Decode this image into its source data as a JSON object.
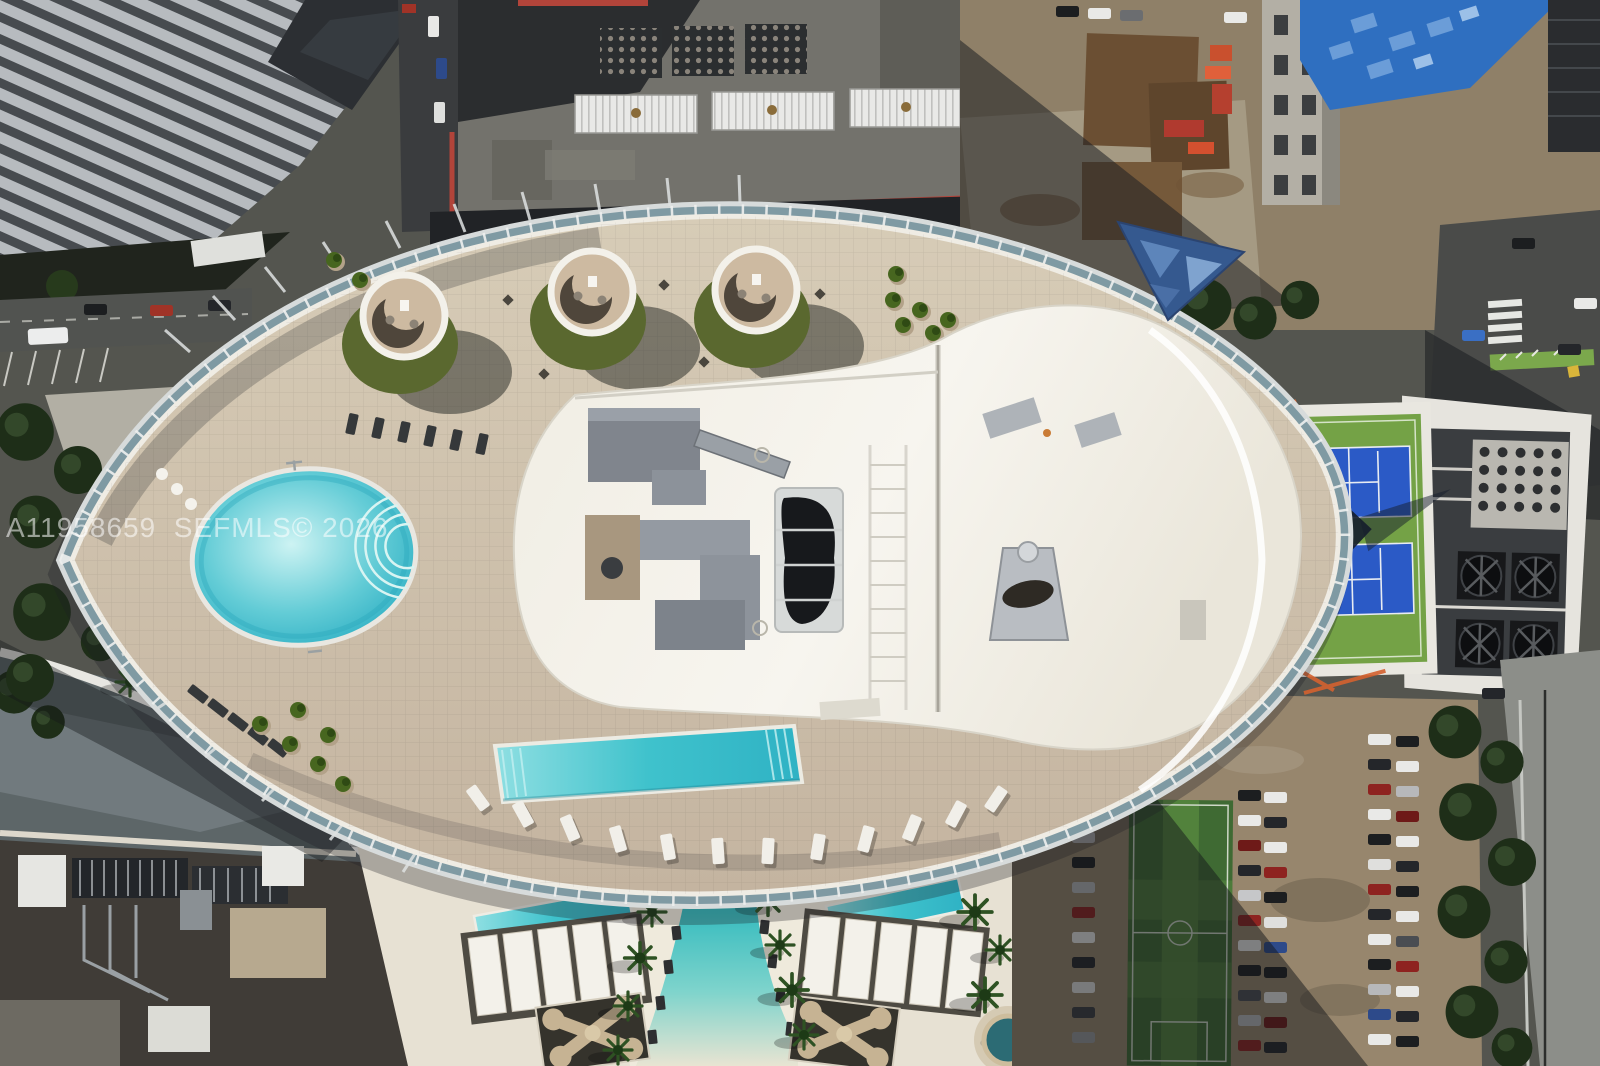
{
  "watermark": {
    "text": "A11958659  SEFMLS© 2026"
  },
  "palette": {
    "asphalt": "#54554f",
    "deck": "#cdc0aa",
    "roof": "#f4f1e9",
    "podGrass": "#5a682f",
    "poolTurquoise": "#35b6c6",
    "rimGlass": "#7f9aa3",
    "courtBlue": "#2b5ac6",
    "courtGreen": "#74a246",
    "fieldGreen": "#3f6a33",
    "dirtTan": "#8f8068",
    "lotTan": "#97866d",
    "hoistBlue": "#2f6fc0",
    "parapetRed": "#b2443a",
    "white": "#eeece6",
    "shadow": "#17191d",
    "watermark": "rgba(255,255,255,0.55)"
  },
  "scene": {
    "type": "aerial-photo",
    "regions": [
      "oval rooftop amenity deck",
      "round pool",
      "lap pool",
      "cabana pods",
      "penthouse roof",
      "glass pyramid skylight",
      "tennis courts",
      "cooling-fan roof",
      "construction site",
      "parking lot",
      "soccer field",
      "ground-level lagoon pool deck",
      "city streets"
    ]
  }
}
